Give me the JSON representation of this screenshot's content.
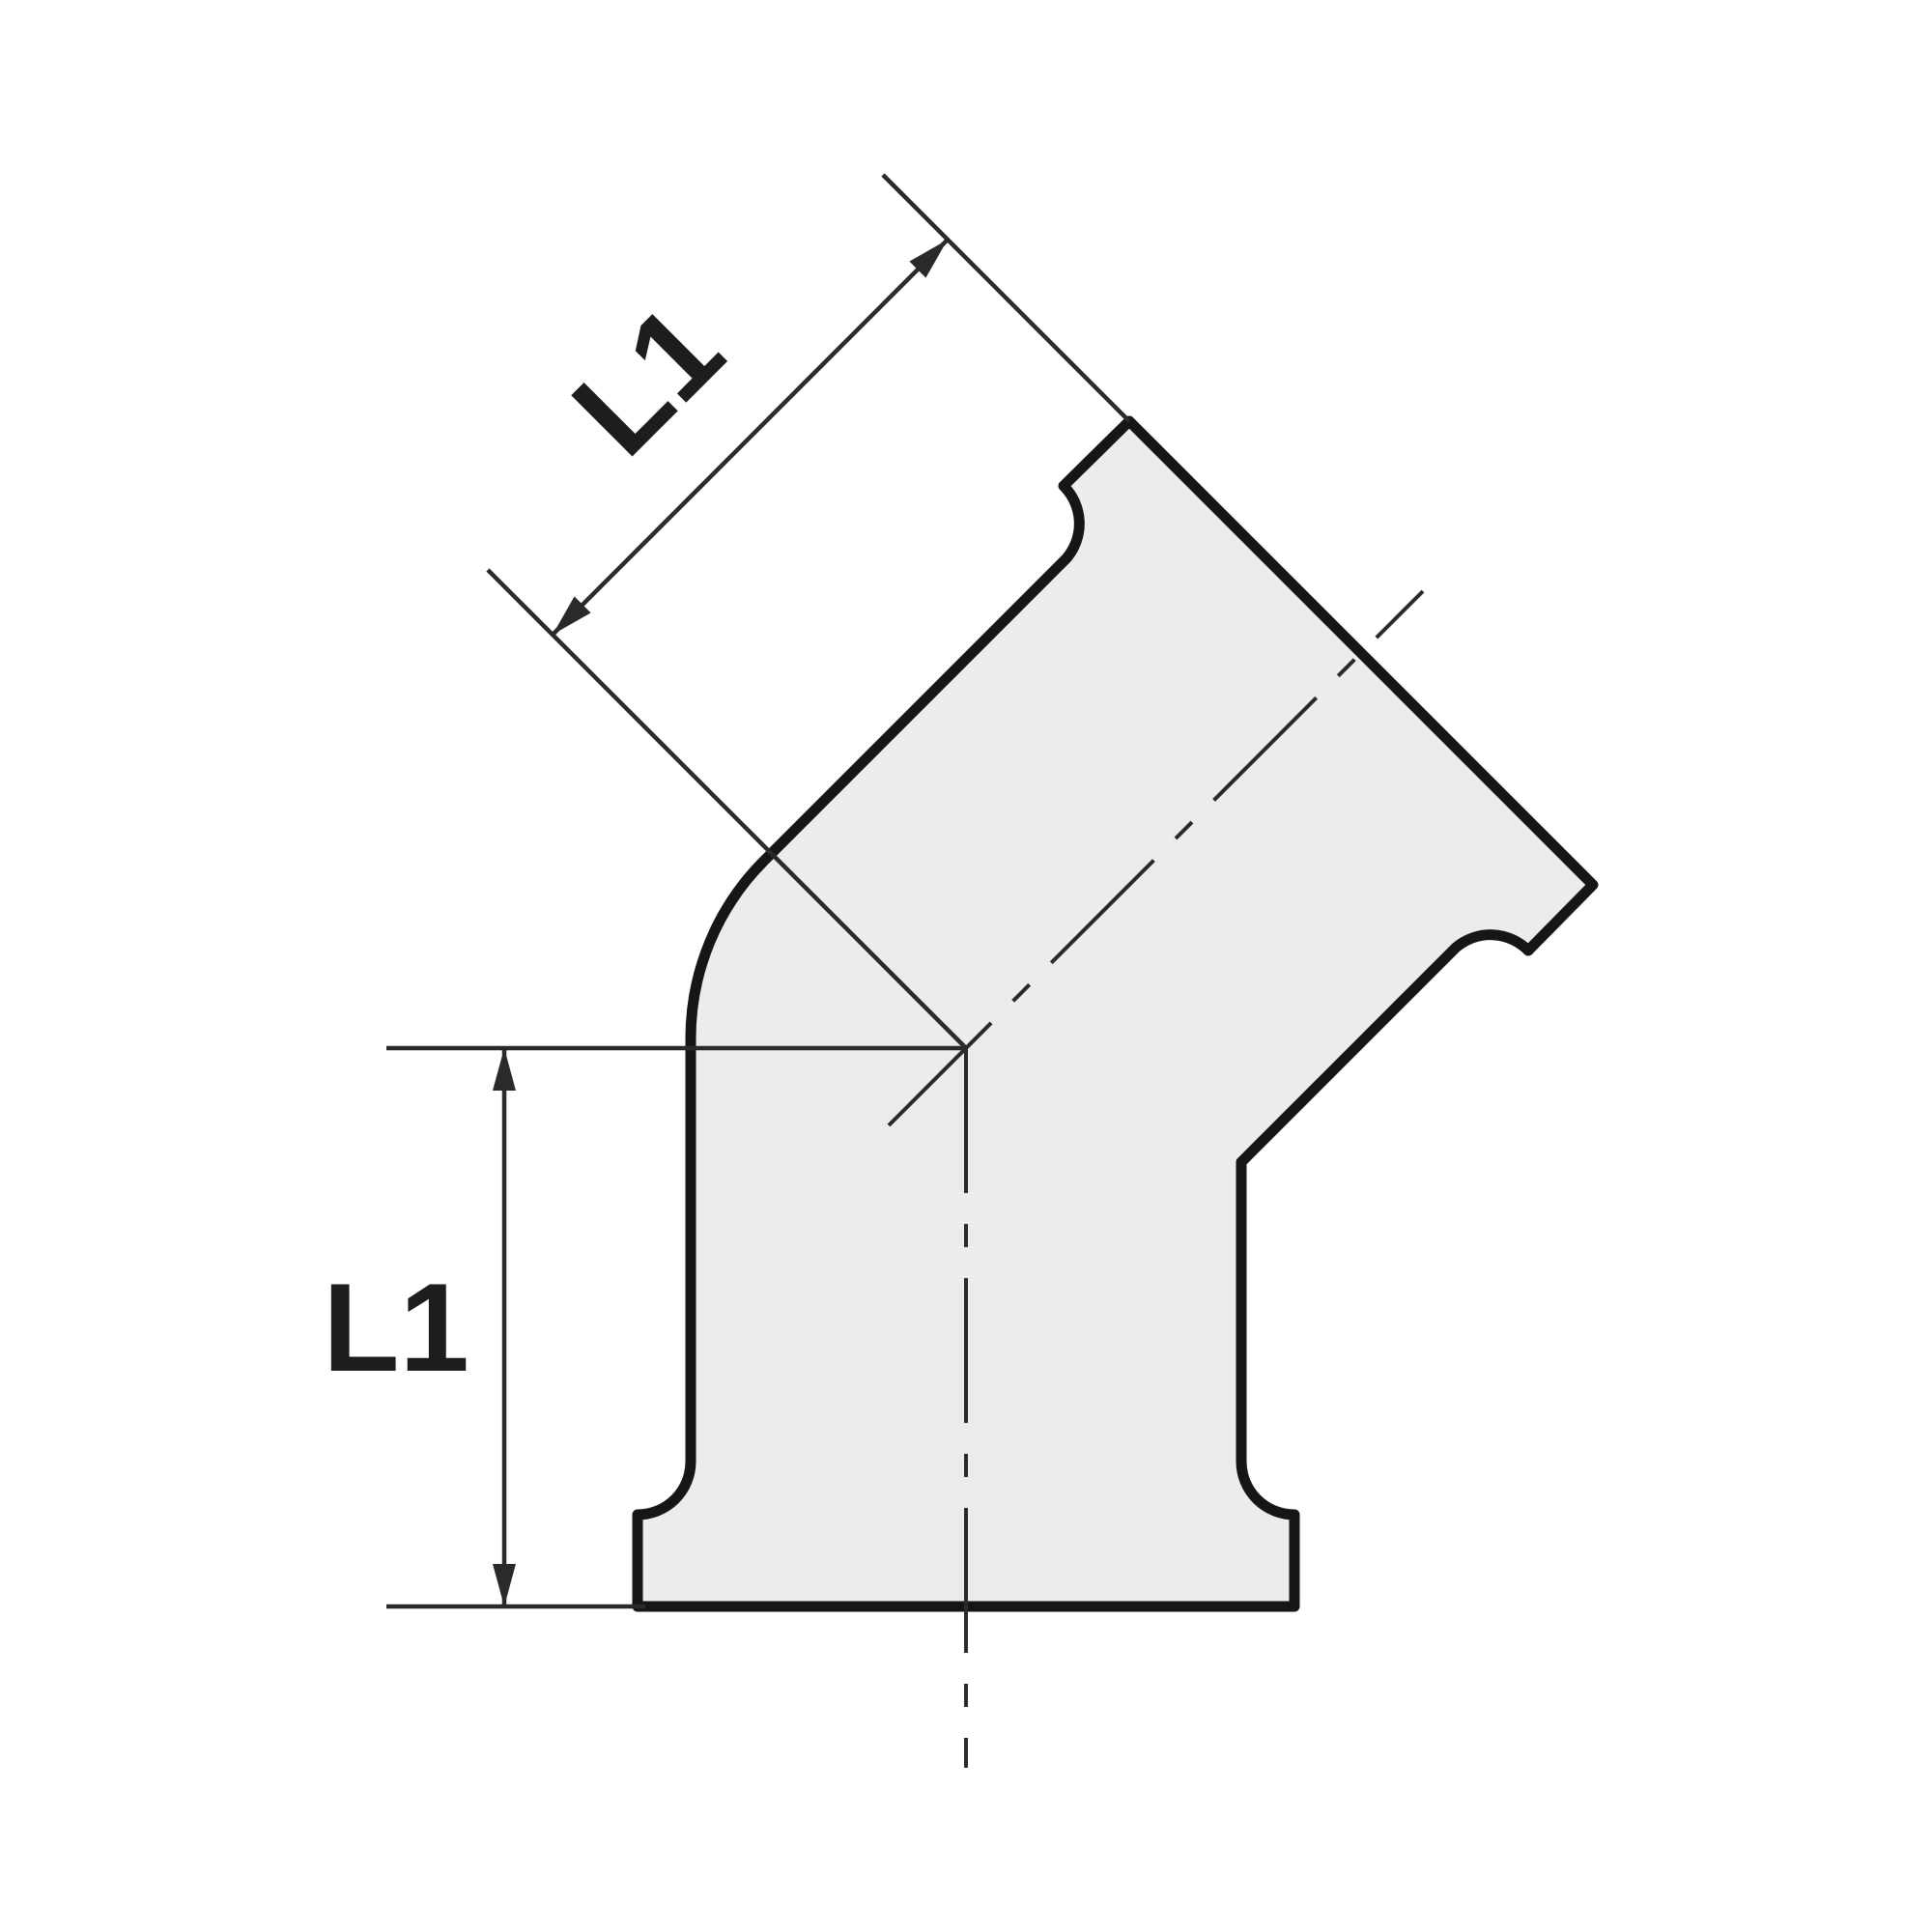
{
  "figure": {
    "labels": {
      "upper_dimension": "L1",
      "lower_dimension": "L1"
    },
    "colors": {
      "background": "#ffffff",
      "body_fill": "#ececee",
      "outline": "#161616",
      "thin_line": "#2a2a2a",
      "label_text": "#1d1d1d"
    }
  }
}
